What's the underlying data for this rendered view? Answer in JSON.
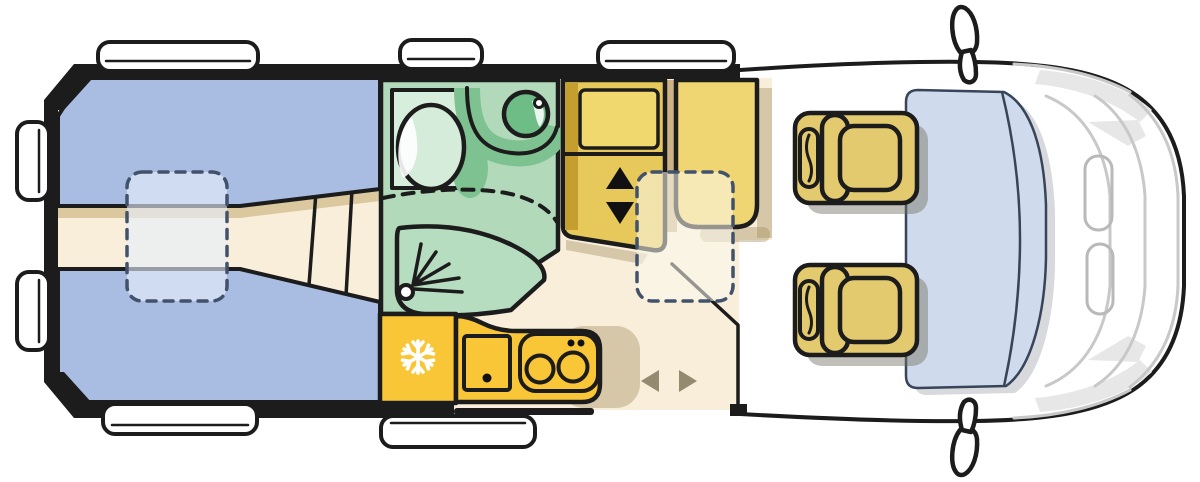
{
  "scene": {
    "type": "vehicle-floor-plan",
    "subject": "Campervan motorhome top-view floor plan",
    "areas": [
      "rear twin single beds",
      "center walkway",
      "bathroom with toilet, washbasin and shower",
      "kitchen with fridge, sink and two-burner stove",
      "tall locker with lift arrows",
      "wardrobe",
      "sliding entry door",
      "cab with two seats"
    ],
    "counts": {
      "beds": 2,
      "cab_seats": 2,
      "windows": 7,
      "dashed_tables": 2,
      "stove_burners": 2
    }
  },
  "colors": {
    "outline": "#1c1c1c",
    "bed": "#a9bde2",
    "floor": "#f8eeda",
    "floorBand": "#dbc89f",
    "bath": "#b2d9ba",
    "bathDark": "#7fc291",
    "bathLight": "#d8eedd",
    "toilet": "#d4ecd9",
    "shower": "#b7ddc0",
    "sink": "#6fbd86",
    "kitchen": "#f8c636",
    "cabinet": "#e7c85b",
    "cabinetDark": "#c49e2e",
    "cabinetPanel": "#f0d76e",
    "gapTan": "#cdb487",
    "wardrobe": "#f0d672",
    "seat": "#e3ca6e",
    "windshield": "#cfdbec",
    "doorArrow": "#948a70",
    "arrow": "#111111",
    "white": "#ffffff",
    "grayLine": "#c8c8c8"
  }
}
